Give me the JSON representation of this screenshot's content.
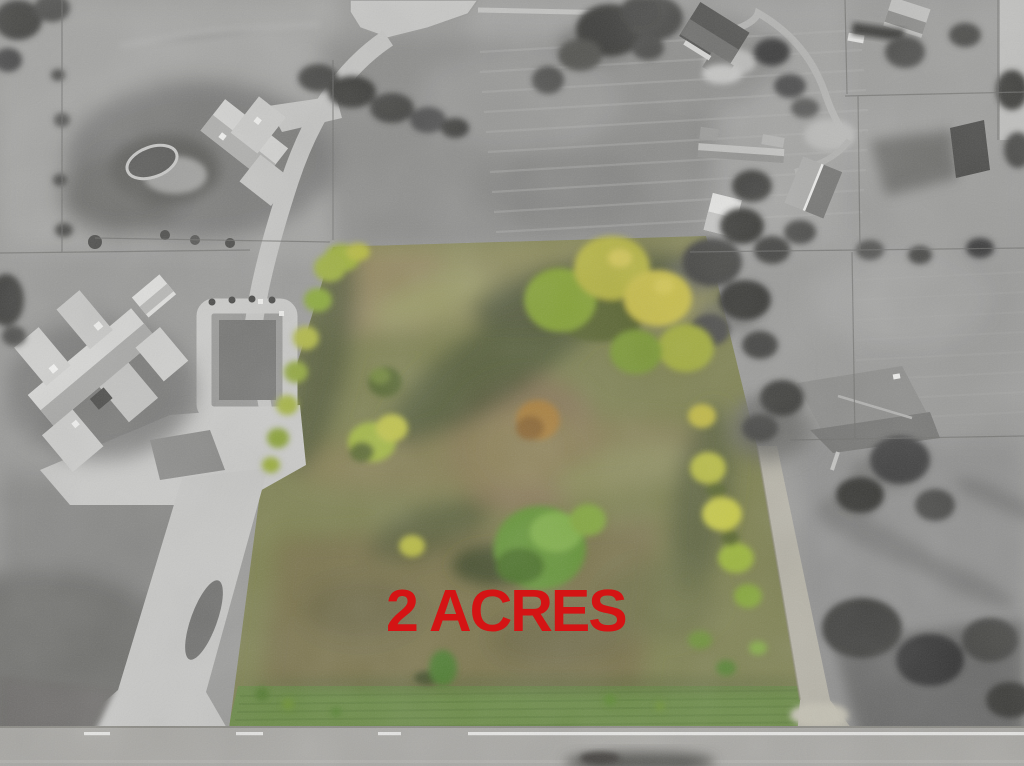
{
  "scene": {
    "type": "aerial-drone-real-estate-photo",
    "label": {
      "text": "2 ACRES",
      "color": "#d41414"
    },
    "palette": {
      "highlight_lot_grass": "#7e8151",
      "highlight_tree_yellow": "#bcbb46",
      "highlight_tree_green": "#679838",
      "dirt_patch": "#89795a",
      "bottom_grass_strip": "#6b8a46",
      "surroundings": "grayscale",
      "road_asphalt": "#a8a7a3",
      "concrete_drive": "#c8c8c6",
      "road_line_white": "#e6e6e4"
    },
    "features": {
      "center": "highlighted-vacant-lot-in-color",
      "surround": "grayscale-pastures-and-estates",
      "top_left": "mansion-with-pool",
      "left": "estate-mansion-with-circular-drive",
      "top_right": "house-with-curved-driveway",
      "right": "farmstead-metal-barn-and-ranch-house",
      "bottom": "two-lane-road-with-white-line",
      "bottom_right": "gravel-driveway-entrance-to-lot"
    }
  }
}
